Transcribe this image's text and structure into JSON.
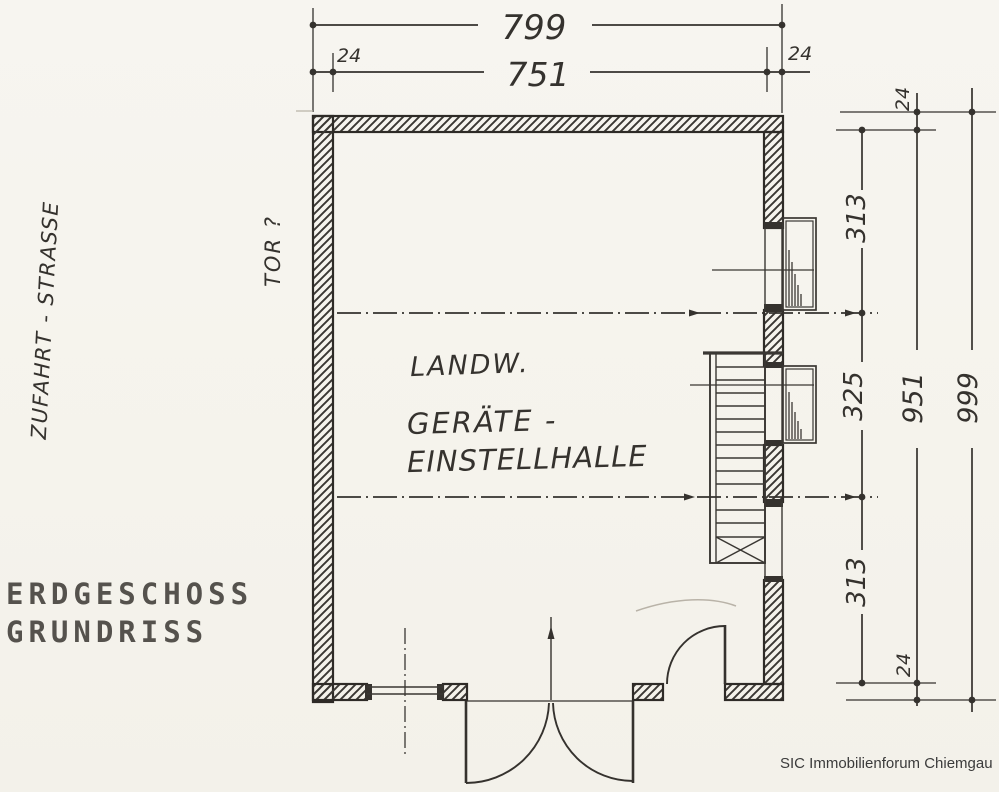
{
  "document": {
    "title_line1": "ERDGESCHOSS",
    "title_line2": "GRUNDRISS",
    "footer": "SIC Immobilienforum Chiemgau"
  },
  "plan": {
    "street_label": "ZUFAHRT - STRASSE",
    "gate_label": "TOR ?",
    "hall_label": {
      "line1": "LANDW.",
      "line2": "GERÄTE -",
      "line3": "EINSTELLHALLE"
    },
    "dimensions": {
      "top_outer_width": "799",
      "top_inner_width": "751",
      "top_wall_left": "24",
      "top_wall_right": "24",
      "right_wall_top": "24",
      "right_segment_top": "313",
      "right_segment_middle": "325",
      "right_segment_bottom": "313",
      "right_wall_bottom": "24",
      "right_inner_height": "951",
      "right_outer_height": "999"
    },
    "colors": {
      "ink": "#35322e",
      "paper": "#f6f4ee",
      "pencil": "#b9b3a8"
    }
  }
}
